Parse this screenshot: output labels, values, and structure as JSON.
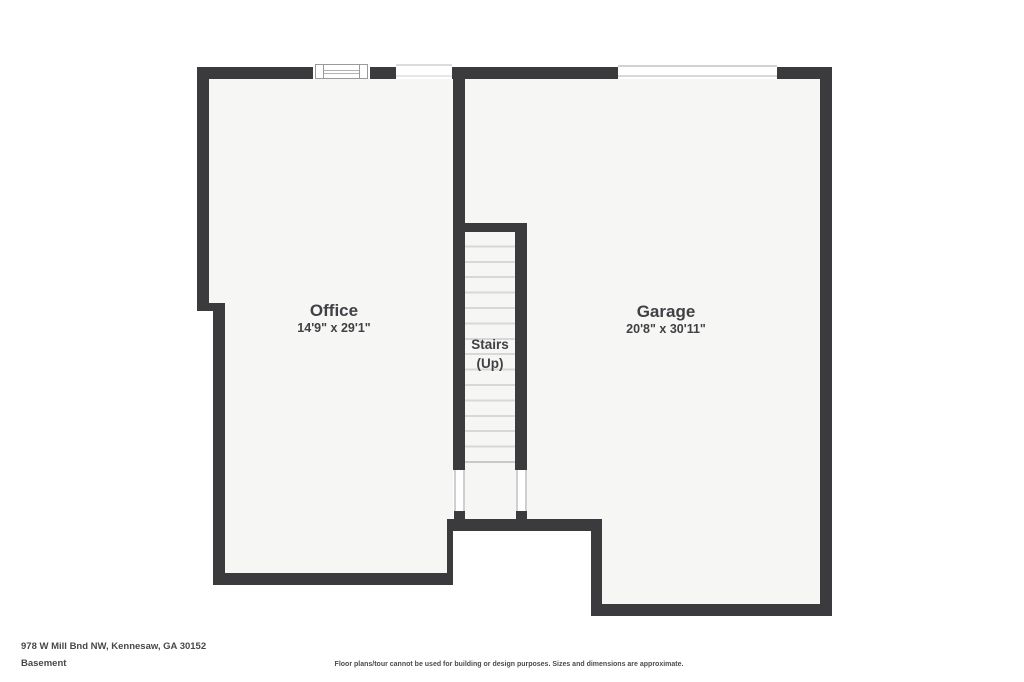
{
  "floor_plan": {
    "rooms": [
      {
        "name": "Office",
        "dimensions": "14'9\" x 29'1\""
      },
      {
        "name": "Garage",
        "dimensions": "20'8\" x 30'11\""
      }
    ],
    "stairs": {
      "line1": "Stairs",
      "line2": "(Up)"
    }
  },
  "footer": {
    "address": "978 W Mill Bnd NW, Kennesaw, GA 30152",
    "level": "Basement",
    "disclaimer": "Floor plans/tour cannot be used for building or design purposes. Sizes and dimensions are approximate."
  },
  "colors": {
    "wall": "#3b3b3d",
    "floor": "#f6f6f5",
    "tread_line": "#d8d8d8",
    "opening_line": "#cfcfcf",
    "window_frame": "#9a9a9a",
    "label_text": "#414145",
    "footer_text": "#48484a"
  }
}
